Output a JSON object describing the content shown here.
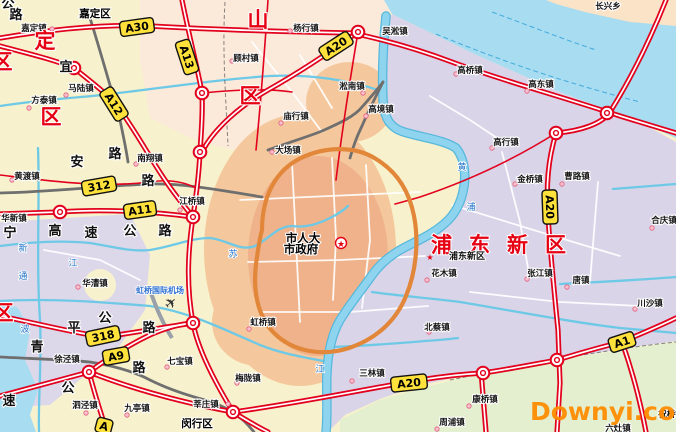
{
  "palette": {
    "water": "#a8dcf0",
    "road_red": "#e2001d",
    "badge_yellow": "#ffe13c",
    "ring_orange": "#e2873a",
    "district_red": "#e60013",
    "watermark_orange": "#ff8c00"
  },
  "watermark": {
    "text": "Downyi.com",
    "color": "#ff8c00"
  },
  "government": {
    "line1": "市人大",
    "line2": "市政府",
    "pudong_office": "浦东新区"
  },
  "airport": {
    "name": "虹桥国际机场"
  },
  "districts_red": [
    {
      "t": "定",
      "x": 45,
      "y": 48
    },
    {
      "t": "区",
      "x": 51,
      "y": 124
    },
    {
      "t": "山",
      "x": 258,
      "y": 27
    },
    {
      "t": "区",
      "x": 250,
      "y": 103
    },
    {
      "t": "区",
      "x": 2,
      "y": 69
    },
    {
      "t": "区",
      "x": 3,
      "y": 320
    },
    {
      "t": "浦东新区",
      "x": 507,
      "y": 252,
      "ls": 17
    }
  ],
  "districts_black": [
    {
      "t": "嘉定区",
      "x": 95,
      "y": 17
    },
    {
      "t": "闵行区",
      "x": 197,
      "y": 427
    }
  ],
  "towns": [
    {
      "t": "嘉定镇",
      "x": 34,
      "y": 31
    },
    {
      "t": "顾村镇",
      "x": 246,
      "y": 61
    },
    {
      "t": "杨行镇",
      "x": 306,
      "y": 31
    },
    {
      "t": "吴淞镇",
      "x": 395,
      "y": 34
    },
    {
      "t": "淞南镇",
      "x": 352,
      "y": 89
    },
    {
      "t": "高境镇",
      "x": 381,
      "y": 112
    },
    {
      "t": "庙行镇",
      "x": 296,
      "y": 119
    },
    {
      "t": "大场镇",
      "x": 288,
      "y": 153
    },
    {
      "t": "马陆镇",
      "x": 81,
      "y": 91
    },
    {
      "t": "方泰镇",
      "x": 44,
      "y": 103
    },
    {
      "t": "黄渡镇",
      "x": 27,
      "y": 179
    },
    {
      "t": "南翔镇",
      "x": 150,
      "y": 161
    },
    {
      "t": "江桥镇",
      "x": 192,
      "y": 204
    },
    {
      "t": "华新镇",
      "x": 14,
      "y": 221
    },
    {
      "t": "华漕镇",
      "x": 95,
      "y": 286
    },
    {
      "t": "徐泾镇",
      "x": 67,
      "y": 362,
      "s": 7.5
    },
    {
      "t": "泗泾镇",
      "x": 85,
      "y": 408
    },
    {
      "t": "九亭镇",
      "x": 137,
      "y": 411
    },
    {
      "t": "七宝镇",
      "x": 180,
      "y": 364
    },
    {
      "t": "莘庄镇",
      "x": 206,
      "y": 407
    },
    {
      "t": "梅陇镇",
      "x": 248,
      "y": 381
    },
    {
      "t": "虹桥镇",
      "x": 263,
      "y": 325
    },
    {
      "t": "三林镇",
      "x": 372,
      "y": 376
    },
    {
      "t": "北蔡镇",
      "x": 437,
      "y": 330
    },
    {
      "t": "周浦镇",
      "x": 452,
      "y": 425
    },
    {
      "t": "康桥镇",
      "x": 485,
      "y": 402
    },
    {
      "t": "川沙镇",
      "x": 650,
      "y": 306
    },
    {
      "t": "高桥镇",
      "x": 470,
      "y": 73
    },
    {
      "t": "高东镇",
      "x": 541,
      "y": 87
    },
    {
      "t": "高行镇",
      "x": 506,
      "y": 145
    },
    {
      "t": "金桥镇",
      "x": 530,
      "y": 182
    },
    {
      "t": "曹路镇",
      "x": 577,
      "y": 179
    },
    {
      "t": "张江镇",
      "x": 540,
      "y": 276
    },
    {
      "t": "唐镇",
      "x": 581,
      "y": 283
    },
    {
      "t": "合庆镇",
      "x": 664,
      "y": 223
    },
    {
      "t": "花木镇",
      "x": 444,
      "y": 276
    },
    {
      "t": "六灶镇",
      "x": 618,
      "y": 431
    },
    {
      "t": "祝桥镇",
      "x": 671,
      "y": 417
    },
    {
      "t": "长兴乡",
      "x": 608,
      "y": 9
    }
  ],
  "dots": [
    [
      52,
      29
    ],
    [
      232,
      61
    ],
    [
      290,
      31
    ],
    [
      363,
      93
    ],
    [
      366,
      116
    ],
    [
      281,
      123
    ],
    [
      272,
      152
    ],
    [
      66,
      95
    ],
    [
      29,
      108
    ],
    [
      12,
      180
    ],
    [
      136,
      164
    ],
    [
      180,
      210
    ],
    [
      78,
      287
    ],
    [
      86,
      413
    ],
    [
      127,
      415
    ],
    [
      167,
      367
    ],
    [
      228,
      404
    ],
    [
      237,
      383
    ],
    [
      249,
      329
    ],
    [
      352,
      381
    ],
    [
      429,
      332
    ],
    [
      437,
      429
    ],
    [
      469,
      406
    ],
    [
      635,
      309
    ],
    [
      456,
      74
    ],
    [
      527,
      91
    ],
    [
      492,
      148
    ],
    [
      515,
      184
    ],
    [
      562,
      184
    ],
    [
      527,
      279
    ],
    [
      567,
      287
    ],
    [
      652,
      228
    ],
    [
      427,
      280
    ]
  ],
  "badges": [
    {
      "t": "A30",
      "x": 137,
      "y": 27,
      "r": -8,
      "w": 34
    },
    {
      "t": "A13",
      "x": 187,
      "y": 57,
      "r": 72,
      "w": 34
    },
    {
      "t": "A12",
      "x": 114,
      "y": 104,
      "r": 58,
      "w": 34
    },
    {
      "t": "A20",
      "x": 336,
      "y": 46,
      "r": -33,
      "w": 34
    },
    {
      "t": "312",
      "x": 99,
      "y": 186,
      "r": -10,
      "w": 34
    },
    {
      "t": "A11",
      "x": 140,
      "y": 210,
      "r": -8,
      "w": 32
    },
    {
      "t": "A20",
      "x": 550,
      "y": 207,
      "r": 88,
      "w": 34
    },
    {
      "t": "A20",
      "x": 409,
      "y": 383,
      "r": -6,
      "w": 36
    },
    {
      "t": "318",
      "x": 103,
      "y": 336,
      "r": -12,
      "w": 34
    },
    {
      "t": "A9",
      "x": 116,
      "y": 356,
      "r": -10,
      "w": 26
    },
    {
      "t": "A1",
      "x": 622,
      "y": 342,
      "r": -18,
      "w": 26
    },
    {
      "t": "A",
      "x": 104,
      "y": 426,
      "r": 15,
      "w": 16
    }
  ],
  "road_chars": [
    {
      "t": "公",
      "x": 8,
      "y": 8
    },
    {
      "t": "路",
      "x": 16,
      "y": 19
    },
    {
      "t": "宜",
      "x": 66,
      "y": 71
    },
    {
      "t": "安",
      "x": 77,
      "y": 166
    },
    {
      "t": "路",
      "x": 115,
      "y": 158
    },
    {
      "t": "路",
      "x": 148,
      "y": 185
    },
    {
      "t": "宁",
      "x": 10,
      "y": 237
    },
    {
      "t": "高",
      "x": 55,
      "y": 235
    },
    {
      "t": "速",
      "x": 91,
      "y": 237
    },
    {
      "t": "公",
      "x": 130,
      "y": 235
    },
    {
      "t": "路",
      "x": 165,
      "y": 235
    },
    {
      "t": "青",
      "x": 37,
      "y": 351
    },
    {
      "t": "平",
      "x": 74,
      "y": 332
    },
    {
      "t": "公",
      "x": 105,
      "y": 322
    },
    {
      "t": "路",
      "x": 149,
      "y": 332
    },
    {
      "t": "路",
      "x": 139,
      "y": 372
    },
    {
      "t": "公",
      "x": 68,
      "y": 392
    },
    {
      "t": "速",
      "x": 9,
      "y": 405
    }
  ],
  "river_chars": [
    {
      "t": "苏",
      "x": 233,
      "y": 257
    },
    {
      "t": "江",
      "x": 73,
      "y": 266
    },
    {
      "t": "黄",
      "x": 462,
      "y": 170
    },
    {
      "t": "浦",
      "x": 471,
      "y": 210
    },
    {
      "t": "江",
      "x": 320,
      "y": 372
    },
    {
      "t": "新",
      "x": 23,
      "y": 251
    },
    {
      "t": "通",
      "x": 23,
      "y": 279
    },
    {
      "t": "波",
      "x": 25,
      "y": 332
    }
  ],
  "interchanges": [
    [
      358,
      32
    ],
    [
      74,
      68
    ],
    [
      202,
      93
    ],
    [
      200,
      152
    ],
    [
      193,
      217
    ],
    [
      60,
      212
    ],
    [
      607,
      113
    ],
    [
      556,
      133
    ],
    [
      193,
      323
    ],
    [
      89,
      372
    ],
    [
      233,
      412
    ],
    [
      483,
      373
    ],
    [
      557,
      360
    ]
  ]
}
